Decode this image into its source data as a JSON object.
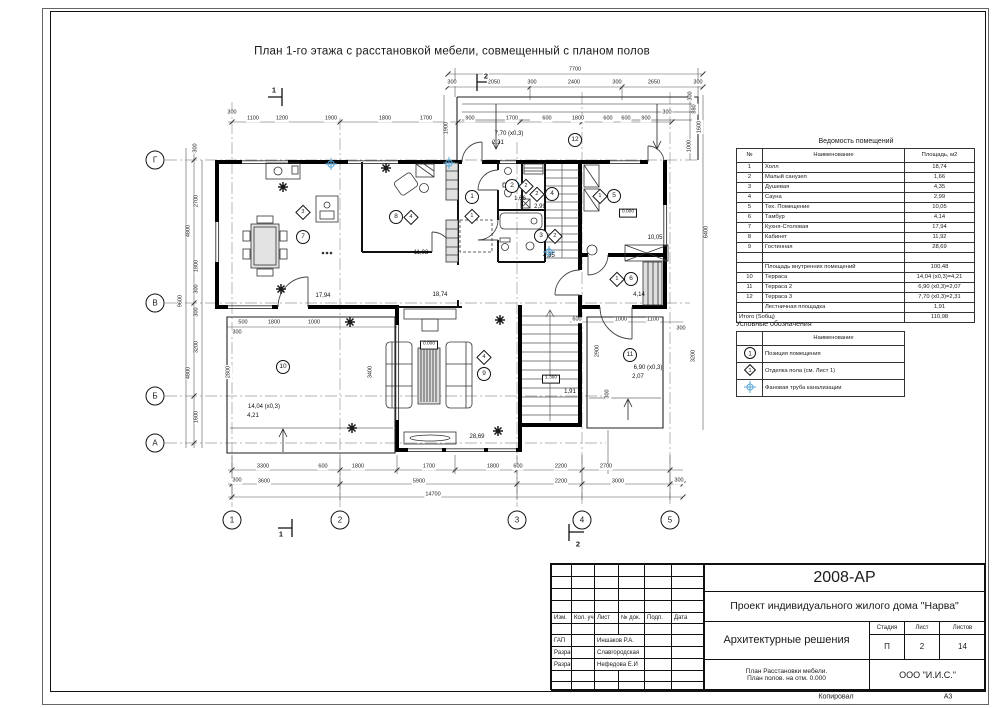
{
  "sheet": {
    "title": "План 1-го этажа с расстановкой мебели, совмещенный с планом полов",
    "footer": {
      "copied": "Копировал",
      "format": "А3"
    }
  },
  "axes": {
    "cols": [
      "1",
      "2",
      "3",
      "4",
      "5"
    ],
    "rows": [
      "Г",
      "В",
      "Б",
      "А"
    ]
  },
  "sections": {
    "top1": "1",
    "top2": "2",
    "bottom1": "1",
    "bottom2": "2"
  },
  "plan": {
    "drain_color": "#5aa7d6",
    "dims": [
      "7700",
      "300",
      "2050",
      "300",
      "2400",
      "300",
      "2650",
      "300",
      "300",
      "1100",
      "1200",
      "1900",
      "1800",
      "1700",
      "900",
      "1700",
      "600",
      "1800",
      "600",
      "600",
      "900",
      "300",
      "1900",
      "1600",
      "300",
      "880",
      "1000",
      "300",
      "2700",
      "4800",
      "1800",
      "300",
      "9600",
      "300",
      "3200",
      "4800",
      "1600",
      "500",
      "1800",
      "1000",
      "300",
      "2800",
      "3400",
      "600",
      "1000",
      "1100",
      "300",
      "2900",
      "3200",
      "6400",
      "3300",
      "600",
      "1800",
      "1700",
      "1800",
      "600",
      "2200",
      "2700",
      "300",
      "3600",
      "5900",
      "2200",
      "3000",
      "300",
      "14700",
      "300"
    ],
    "rooms": [
      {
        "n": "1",
        "f": "1",
        "a": "18,74"
      },
      {
        "n": "2",
        "f": "2",
        "a": "1,66"
      },
      {
        "n": "3",
        "f": "2",
        "a": "4,35"
      },
      {
        "n": "4",
        "f": "2",
        "a": "2,99"
      },
      {
        "n": "5",
        "f": "1",
        "a": "10,05",
        "lvl": "0.000"
      },
      {
        "n": "6",
        "f": "1",
        "a": "4,14"
      },
      {
        "n": "7",
        "f": "3",
        "a": "17,94"
      },
      {
        "n": "8",
        "f": "4",
        "a": "11,92"
      },
      {
        "n": "9",
        "f": "4",
        "a": "28,69",
        "lvl": "0.000"
      },
      {
        "n": "10",
        "a": "14,04 (x0,3)",
        "a2": "4,21"
      },
      {
        "n": "11",
        "a": "6,90 (x0,3)",
        "a2": "2,07"
      },
      {
        "n": "12",
        "a": "7,70 (x0,3)",
        "a2": "2,31"
      }
    ],
    "stairs": {
      "lvl": "1.360",
      "a": "1,91"
    }
  },
  "schedule": {
    "title": "Ведомость помещений",
    "headers": {
      "n": "№",
      "name": "Наименование",
      "area": "Площадь, м2"
    },
    "rows": [
      {
        "n": "1",
        "name": "Холл",
        "area": "18,74"
      },
      {
        "n": "2",
        "name": "Малый санузел",
        "area": "1,66"
      },
      {
        "n": "3",
        "name": "Душевая",
        "area": "4,35"
      },
      {
        "n": "4",
        "name": "Сауна",
        "area": "2,99"
      },
      {
        "n": "5",
        "name": "Тех. Помещение",
        "area": "10,05"
      },
      {
        "n": "6",
        "name": "Тамбур",
        "area": "4,14"
      },
      {
        "n": "7",
        "name": "Кухня-Столовая",
        "area": "17,94"
      },
      {
        "n": "8",
        "name": "Кабинет",
        "area": "11,92"
      },
      {
        "n": "9",
        "name": "Гостинная",
        "area": "28,69"
      },
      {
        "n": "",
        "name": "",
        "area": ""
      },
      {
        "n": "",
        "name": "Площадь внутренних помещений",
        "area": "100,48"
      },
      {
        "n": "10",
        "name": "Терраса",
        "area": "14,04 (x0,3)=4,21"
      },
      {
        "n": "11",
        "name": "Терраса 2",
        "area": "6,90 (x0,3)=2,07"
      },
      {
        "n": "12",
        "name": "Терраса 3",
        "area": "7,70 (x0,3)=2,31"
      },
      {
        "n": "",
        "name": "Лестничная площадка",
        "area": "1,91"
      },
      {
        "n": "Итого (Sобщ)",
        "name": "",
        "area": "110,98"
      }
    ]
  },
  "legend": {
    "title": "Условные обозначения",
    "header": "Наименование",
    "items": [
      {
        "sym": "1",
        "name": "Позиция помещения"
      },
      {
        "sym": "1",
        "name": "Отделка пола (см. Лист 1)"
      },
      {
        "sym": "",
        "name": "Фановая труба канализации"
      }
    ]
  },
  "titleblock": {
    "code": "2008-АР",
    "project": "Проект индивидуального жилого дома \"Нарва\"",
    "section": "Архитектурные решения",
    "cols": {
      "izm": "Изм.",
      "kol": "Кол. уч.",
      "list": "Лист",
      "doc": "№ док.",
      "podp": "Подп.",
      "data": "Дата"
    },
    "roles": [
      {
        "role": "ГАП",
        "name": "Иншаков Р.А."
      },
      {
        "role": "Разраб.",
        "name": "Славгородская"
      },
      {
        "role": "Разраб.",
        "name": "Нефедова Е.И"
      }
    ],
    "stage_label": "Стадия",
    "sheet_label": "Лист",
    "sheets_label": "Листов",
    "stage": "П",
    "sheet_num": "2",
    "sheets_total": "14",
    "drawing_name1": "План Расстановки мебели.",
    "drawing_name2": "План полов. на отм. 0.000",
    "company": "ООО \"И.И.С.\""
  }
}
